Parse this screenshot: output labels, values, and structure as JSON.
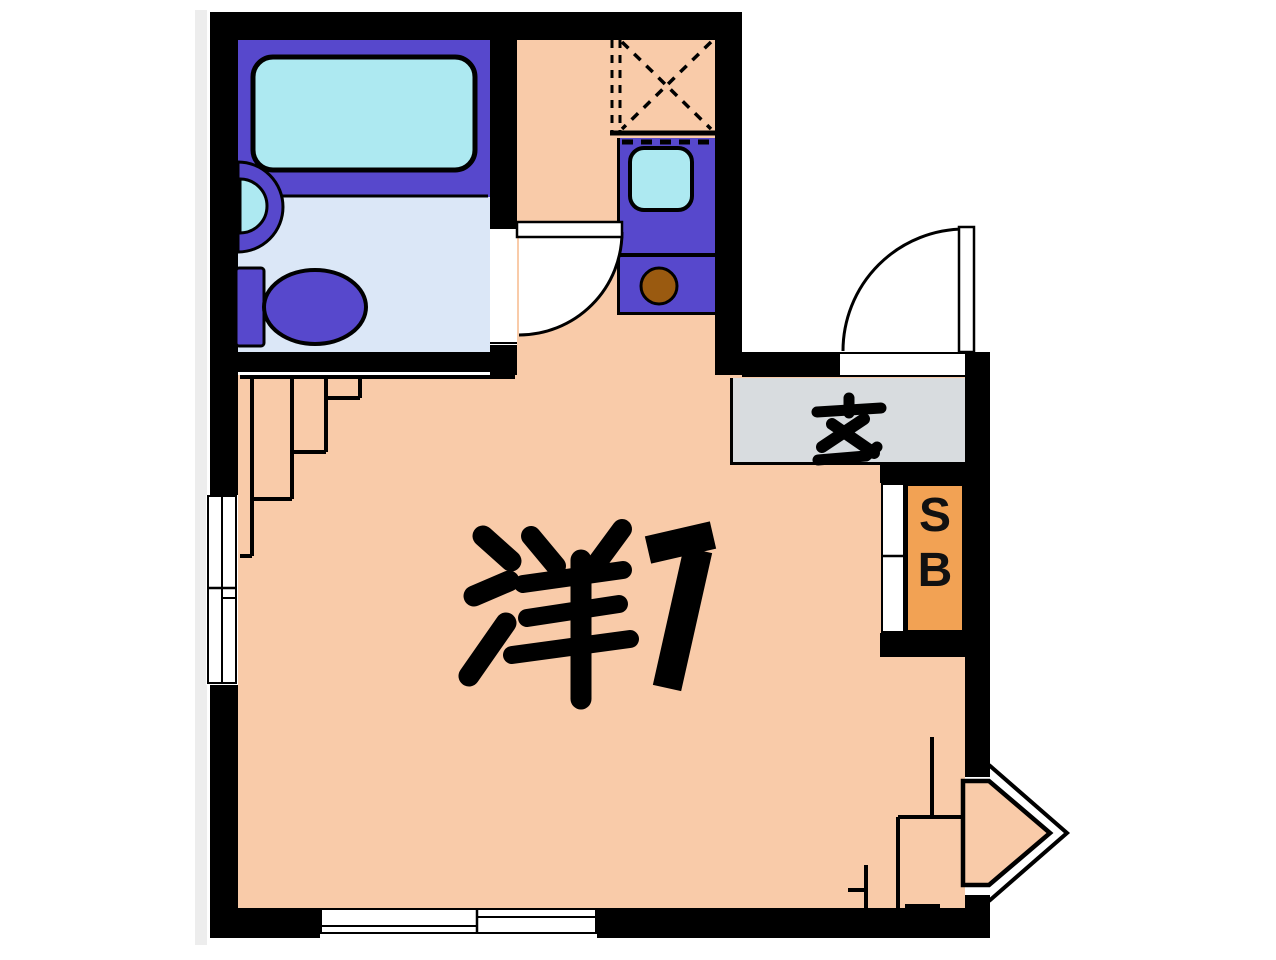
{
  "floorplan": {
    "room": {
      "label": "洋7",
      "kanji": "洋",
      "size_digit": "7",
      "meaning": "western-style room, 7 mats"
    },
    "entrance": {
      "label": "玄",
      "meaning": "genkan entrance"
    },
    "shoebox": {
      "label": "SB",
      "line1": "S",
      "line2": "B"
    },
    "fixtures": [
      "bathtub",
      "washbasin",
      "toilet",
      "bathroom-door",
      "washing-machine-space",
      "kitchen-sink",
      "gas-burner",
      "entrance-door",
      "genkan",
      "shoe-box",
      "left-window",
      "bottom-window",
      "bay-window"
    ],
    "colors": {
      "wall": "#000000",
      "room_floor": "#f9cba9",
      "unit": "#5748cc",
      "tub": "#ade9f1",
      "bath_floor": "#dbe7f7",
      "genkan": "#d8dcdf",
      "shoebox": "#f2a254",
      "burner": "#9a5a10",
      "background": "#ffffff"
    }
  }
}
